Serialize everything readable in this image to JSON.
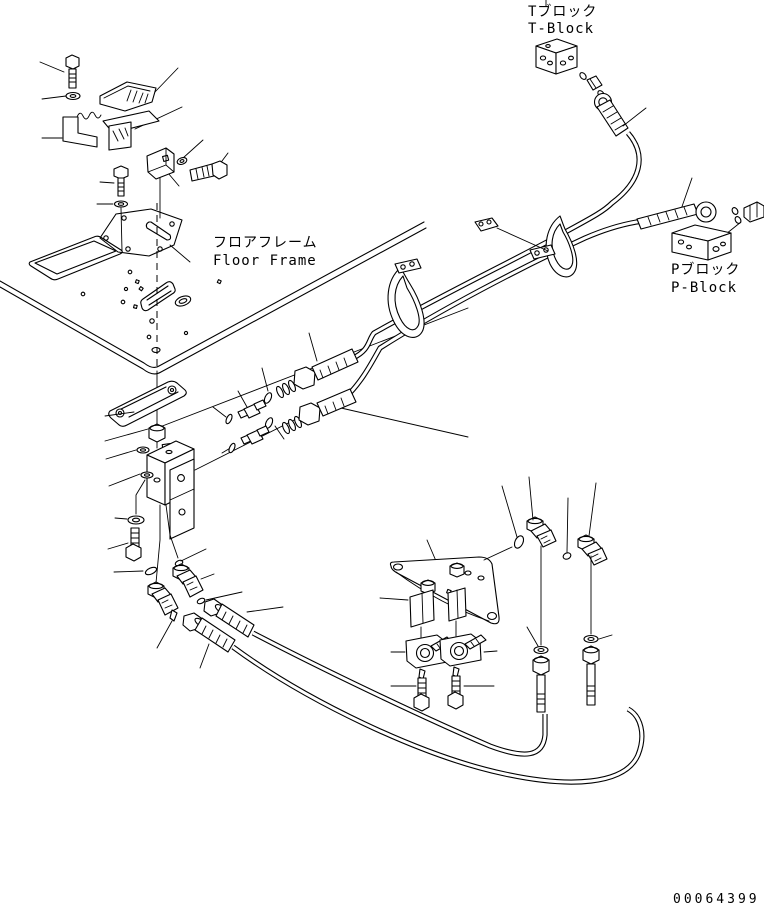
{
  "drawing": {
    "colors": {
      "background": "#ffffff",
      "line": "#000000"
    },
    "labels": {
      "t_block_jp": "Tブロック",
      "t_block_en": "T-Block",
      "floor_frame_jp": "フロアフレーム",
      "floor_frame_en": "Floor Frame",
      "p_block_jp": "Pブロック",
      "p_block_en": "P-Block"
    },
    "number": "00064399"
  }
}
